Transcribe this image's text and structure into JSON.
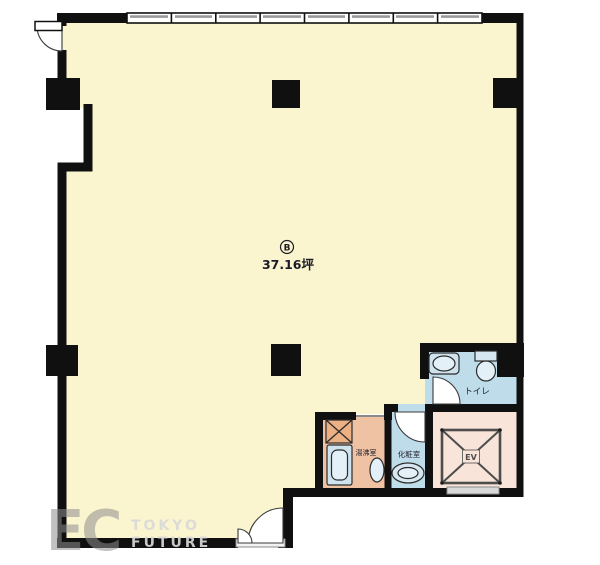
{
  "plan": {
    "unit": {
      "label": "B",
      "area": "37.16坪"
    },
    "rooms": {
      "toilet": {
        "label": "トイレ"
      },
      "powder": {
        "label": "化粧室"
      },
      "kitchenette": {
        "label": "湯沸室"
      },
      "elevator": {
        "label": "EV"
      }
    },
    "watermark": {
      "logo": "EC",
      "line1": "TOKYO",
      "line2": "FUTURE"
    },
    "colors": {
      "wall": "#101010",
      "main_room": "#FAF5CE",
      "wet_room": "#BFDCEA",
      "wet_room_fixture": "#E4F0F7",
      "kitchenette_room": "#EFC2A4",
      "elevator_room": "#F8E4D8"
    }
  }
}
